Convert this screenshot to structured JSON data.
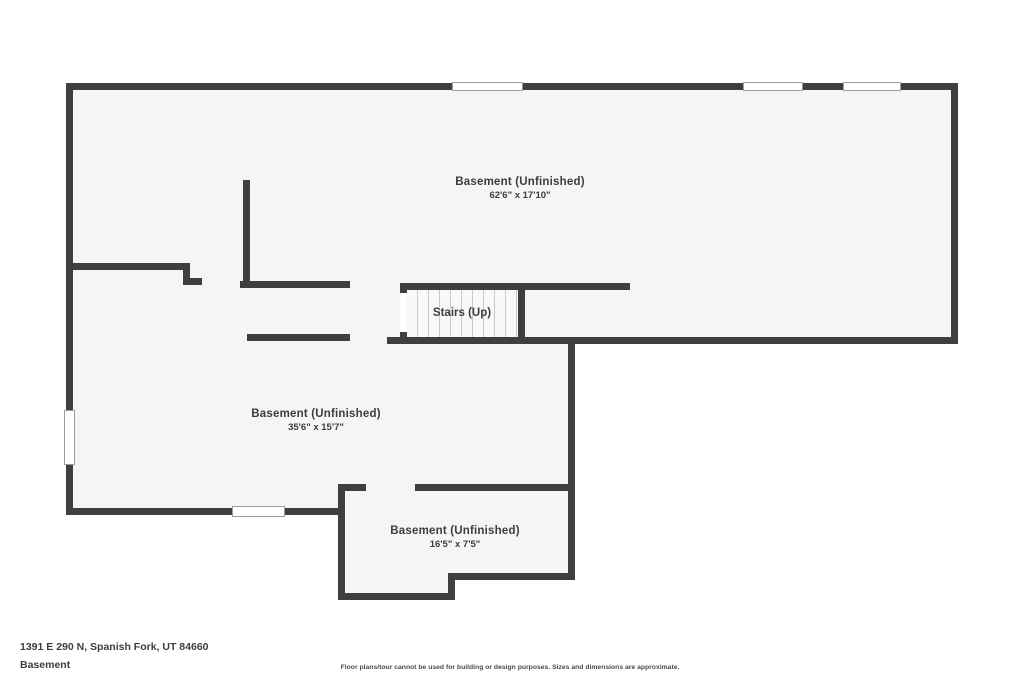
{
  "plan": {
    "rooms": [
      {
        "name": "Basement (Unfinished)",
        "dims": "62'6\" x 17'10\""
      },
      {
        "name": "Basement (Unfinished)",
        "dims": "35'6\" x 15'7\""
      },
      {
        "name": "Basement (Unfinished)",
        "dims": "16'5\" x 7'5\""
      }
    ],
    "stairs": {
      "label": "Stairs (Up)",
      "step_count": 10
    },
    "windows": {
      "top_wall": 3,
      "left_wall": 1,
      "bottom_wall": 1
    },
    "colors": {
      "wall": "#3f3f3f",
      "interior_fill": "#f5f5f5",
      "stair_tread_line": "#c9c9c9",
      "text": "#3d3d3d",
      "outside": "#ffffff"
    }
  },
  "footer": {
    "address": "1391 E 290 N, Spanish Fork, UT 84660",
    "floor": "Basement",
    "disclaimer": "Floor plans/tour cannot be used for building or design purposes. Sizes and dimensions are approximate."
  }
}
